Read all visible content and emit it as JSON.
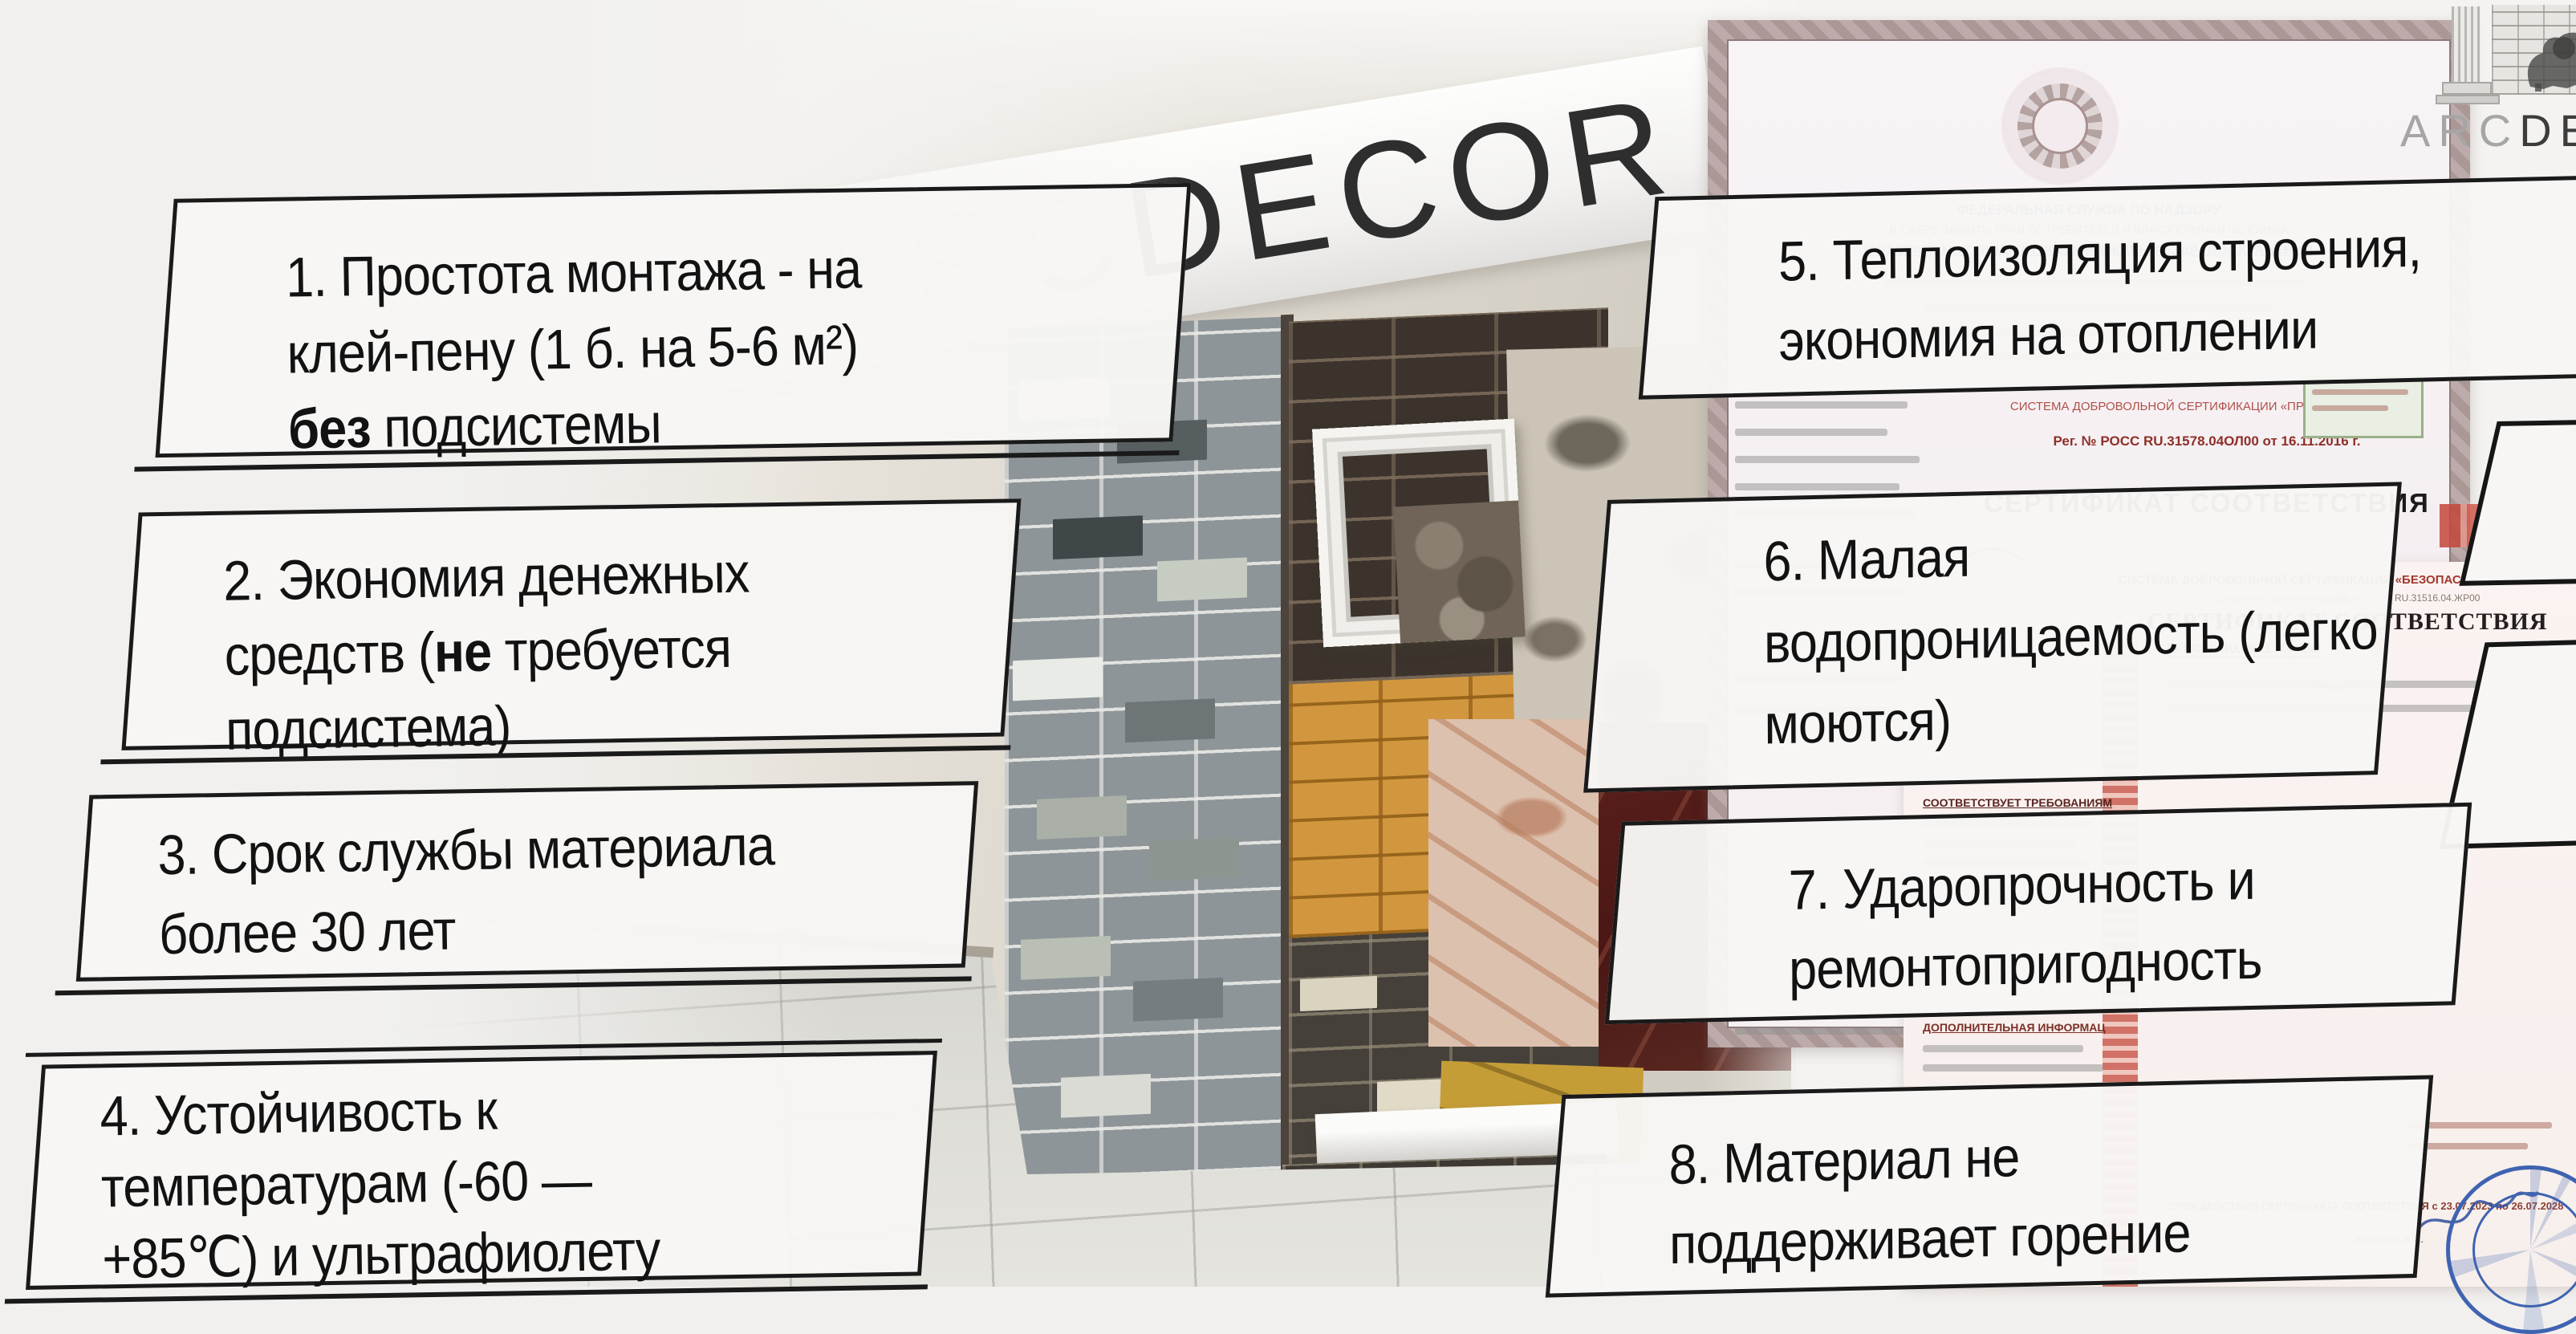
{
  "logo": {
    "arc": "ARC",
    "decor": "DECOR"
  },
  "showroom_sign": {
    "arc": "ARC",
    "decor": "DECOR"
  },
  "callouts": [
    {
      "id": "b1",
      "segments": [
        {
          "text": "1. Простота монтажа - на"
        },
        {
          "br": true
        },
        {
          "text": "клей-пену (1 б. на 5-6 м²)"
        },
        {
          "br": true
        },
        {
          "text": "без",
          "bold": true
        },
        {
          "text": " подсистемы"
        }
      ]
    },
    {
      "id": "b2",
      "segments": [
        {
          "text": "2. Экономия денежных"
        },
        {
          "br": true
        },
        {
          "text": "средств ("
        },
        {
          "text": "не",
          "bold": true
        },
        {
          "text": " требуется"
        },
        {
          "br": true
        },
        {
          "text": "подсистема)"
        }
      ]
    },
    {
      "id": "b3",
      "segments": [
        {
          "text": "3. Срок службы материала"
        },
        {
          "br": true
        },
        {
          "text": "более 30 лет"
        }
      ]
    },
    {
      "id": "b4",
      "segments": [
        {
          "text": "4. Устойчивость к"
        },
        {
          "br": true
        },
        {
          "text": "температурам (-60 —"
        },
        {
          "br": true
        },
        {
          "text": "+85℃) и ультрафиолету"
        }
      ]
    },
    {
      "id": "b5",
      "segments": [
        {
          "text": "5. Теплоизоляция строения,"
        },
        {
          "br": true
        },
        {
          "text": "экономия на отоплении"
        }
      ]
    },
    {
      "id": "b6",
      "segments": [
        {
          "text": "6. Малая"
        },
        {
          "br": true
        },
        {
          "text": "водопроницаемость (легко"
        },
        {
          "br": true
        },
        {
          "text": "моются)"
        }
      ]
    },
    {
      "id": "b7",
      "segments": [
        {
          "text": "7. Ударопрочность и"
        },
        {
          "br": true
        },
        {
          "text": "ремонтопригодность"
        }
      ]
    },
    {
      "id": "b8",
      "segments": [
        {
          "text": "8. Материал не"
        },
        {
          "br": true
        },
        {
          "text": "поддерживает горение"
        }
      ]
    }
  ],
  "cert_top": {
    "header1": "ФЕДЕРАЛЬНАЯ СЛУЖБА ПО НАДЗОРУ",
    "header2": "В СФЕРЕ ЗАЩИТЫ ПРАВ ПОТРЕБИТЕЛЕЙ И БЛАГОПОЛУЧИЯ ЧЕЛОВЕКА",
    "header3": "ФЕДЕРАЛЬНОЕ БЮДЖЕТНОЕ УЧРЕЖДЕНИЕ ЗДРАВООХРАНЕНИЯ",
    "system_line": "СИСТЕМА ДОБРОВОЛЬНОЙ СЕРТИФИКАЦИИ «ПРИБОР-ЭКСПЕРТ»",
    "reg_line": "Рег. № РОСС RU.31578.04ОЛ00 от 16.11.2016 г.",
    "title": "СЕРТИФИКАТ СООТВЕТСТВИЯ",
    "stamp_text": "ПЭ"
  },
  "cert_bottom": {
    "system_line": "СИСТЕМА ДОБРОВОЛЬНОЙ СЕРТИФИКАЦИИ «БЕЗОПАСНОСТЬ И КАЧЕСТВО»",
    "reg_line": "Свидетельство о регистрации № РОСС RU.31516.04.ЖР00",
    "title": "СЕРТИФИКАТ СООТВЕТСТВИЯ",
    "number": "№  ССБК RU.ПБ21.Н.00192",
    "number_right": "№ ПС",
    "requirements_label": "СООТВЕТСТВУЕТ ТРЕБОВАНИЯМ",
    "additional_label": "ДОПОЛНИТЕЛЬНАЯ ИНФОРМАЦ",
    "validity_line": "СРОК ДЕЙСТВИЯ СЕРТИФИКАТА СООТВЕТСТВИЯ    с 23.07.2023  по  26.07.2028",
    "signature_name": "Ерофеев А.И."
  },
  "colors": {
    "callout_border": "#1a1a1a",
    "callout_bg": "#f7f6f4",
    "sign_dark": "#2e2e2e",
    "sign_light": "#c3c3c1",
    "brick_orange": "#d2973e",
    "cert_red": "#8e2f28",
    "cert_blue": "#3f4e8c",
    "stamp_blue": "#3f63b0"
  }
}
